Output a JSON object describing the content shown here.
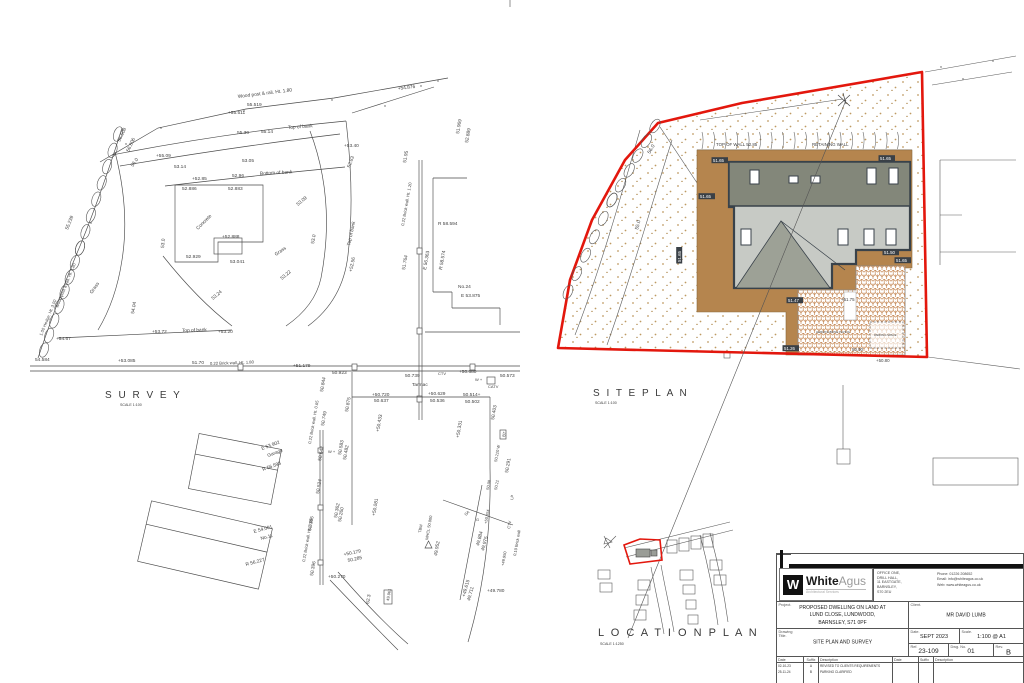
{
  "survey": {
    "title": "S U R V E Y",
    "scale_note": "SCALE 1:100",
    "labels": [
      {
        "t": "Wood post & rail. Ht. 1.80",
        "x": 238,
        "y": 98,
        "r": -7
      },
      {
        "t": "+55.511",
        "x": 228,
        "y": 114
      },
      {
        "t": "55.519",
        "x": 247,
        "y": 106
      },
      {
        "t": "+54.876",
        "x": 398,
        "y": 90,
        "r": -7
      },
      {
        "t": "55.30",
        "x": 237,
        "y": 134
      },
      {
        "t": "55.14",
        "x": 261,
        "y": 133
      },
      {
        "t": "Top of bank",
        "x": 288,
        "y": 129,
        "r": -4
      },
      {
        "t": "+53.40",
        "x": 344,
        "y": 147
      },
      {
        "t": "52.83",
        "x": 350,
        "y": 168,
        "r": -70
      },
      {
        "t": "+55.09",
        "x": 156,
        "y": 157
      },
      {
        "t": "53.14",
        "x": 174,
        "y": 168
      },
      {
        "t": "53.05",
        "x": 242,
        "y": 162
      },
      {
        "t": "52.96",
        "x": 232,
        "y": 177
      },
      {
        "t": "Bottom of bank",
        "x": 260,
        "y": 175,
        "r": -3
      },
      {
        "t": "+52.85",
        "x": 192,
        "y": 180
      },
      {
        "t": "52.886",
        "x": 182,
        "y": 190
      },
      {
        "t": "52.883",
        "x": 228,
        "y": 190
      },
      {
        "t": "Concrete",
        "x": 198,
        "y": 230,
        "r": -45
      },
      {
        "t": "+52.888",
        "x": 222,
        "y": 238
      },
      {
        "t": "52.929",
        "x": 186,
        "y": 258
      },
      {
        "t": "53.041",
        "x": 230,
        "y": 263
      },
      {
        "t": "Grass",
        "x": 276,
        "y": 256,
        "r": -35
      },
      {
        "t": "53.09",
        "x": 298,
        "y": 206,
        "r": -40
      },
      {
        "t": "53.0",
        "x": 314,
        "y": 244,
        "r": -80
      },
      {
        "t": "53.0",
        "x": 164,
        "y": 248,
        "r": -85
      },
      {
        "t": "Top of bank",
        "x": 350,
        "y": 246,
        "r": -78
      },
      {
        "t": "+52.56",
        "x": 352,
        "y": 272,
        "r": -78
      },
      {
        "t": "53.22",
        "x": 282,
        "y": 280,
        "r": -40
      },
      {
        "t": "53.24",
        "x": 213,
        "y": 300,
        "r": -40
      },
      {
        "t": "Grass",
        "x": 92,
        "y": 294,
        "r": -55
      },
      {
        "t": "56.608",
        "x": 120,
        "y": 142,
        "r": -65
      },
      {
        "t": "56.806",
        "x": 129,
        "y": 152,
        "r": -65
      },
      {
        "t": "56.0",
        "x": 133,
        "y": 167,
        "r": -55
      },
      {
        "t": "55.239",
        "x": 68,
        "y": 230,
        "r": -68
      },
      {
        "t": "Wood post & rail. Ht. 1.80",
        "x": 58,
        "y": 308,
        "r": -68,
        "s": 4.2
      },
      {
        "t": "1.00 Hedge. Ht. 3.00",
        "x": 42,
        "y": 336,
        "r": -68,
        "s": 4.2
      },
      {
        "t": "+54.67",
        "x": 56,
        "y": 340
      },
      {
        "t": "54.04",
        "x": 134,
        "y": 314,
        "r": -80
      },
      {
        "t": "+53.72",
        "x": 152,
        "y": 333
      },
      {
        "t": "Top of bank",
        "x": 182,
        "y": 332,
        "r": -2
      },
      {
        "t": "+53.20",
        "x": 218,
        "y": 333
      },
      {
        "t": "54.584",
        "x": 35,
        "y": 361
      },
      {
        "t": "+53.085",
        "x": 118,
        "y": 362
      },
      {
        "t": "51.70",
        "x": 192,
        "y": 364
      },
      {
        "t": "0.22 Brick wall. Ht. 1.80",
        "x": 210,
        "y": 365,
        "r": -2,
        "s": 4.2
      },
      {
        "t": "+51.179",
        "x": 293,
        "y": 367
      },
      {
        "t": "50.923",
        "x": 332,
        "y": 374
      },
      {
        "t": "50.844",
        "x": 323,
        "y": 392,
        "r": -80
      },
      {
        "t": "50.739",
        "x": 405,
        "y": 377
      },
      {
        "t": "CTV",
        "x": 438,
        "y": 375,
        "s": 4
      },
      {
        "t": "+50.680",
        "x": 459,
        "y": 373
      },
      {
        "t": "W +",
        "x": 475,
        "y": 381,
        "s": 4
      },
      {
        "t": "50.573",
        "x": 500,
        "y": 377
      },
      {
        "t": "CATV",
        "x": 488,
        "y": 388,
        "s": 4
      },
      {
        "t": "Tarmac",
        "x": 412,
        "y": 386
      },
      {
        "t": "+50.720",
        "x": 372,
        "y": 396
      },
      {
        "t": "50.637",
        "x": 374,
        "y": 402
      },
      {
        "t": "+50.629",
        "x": 428,
        "y": 395
      },
      {
        "t": "50.536",
        "x": 430,
        "y": 402
      },
      {
        "t": "50.514+",
        "x": 463,
        "y": 396
      },
      {
        "t": "50.502",
        "x": 465,
        "y": 403
      },
      {
        "t": "50.875",
        "x": 348,
        "y": 412,
        "r": -80
      },
      {
        "t": "+50.433",
        "x": 379,
        "y": 432,
        "r": -80
      },
      {
        "t": "+50.331",
        "x": 459,
        "y": 438,
        "r": -80
      },
      {
        "t": "50.403",
        "x": 494,
        "y": 420,
        "r": -80
      },
      {
        "t": "0.22 Brick wall. Ht. 0.65",
        "x": 311,
        "y": 444,
        "r": -80,
        "s": 4.2
      },
      {
        "t": "50.749",
        "x": 324,
        "y": 426,
        "r": -80
      },
      {
        "t": "W +",
        "x": 328,
        "y": 453,
        "s": 4
      },
      {
        "t": "50.583",
        "x": 341,
        "y": 455,
        "r": -80
      },
      {
        "t": "50.482",
        "x": 346,
        "y": 460,
        "r": -80
      },
      {
        "t": "50.642",
        "x": 321,
        "y": 461,
        "r": -80
      },
      {
        "t": "BT",
        "x": 505,
        "y": 437,
        "r": -80,
        "s": 4
      },
      {
        "t": "50.291",
        "x": 508,
        "y": 473,
        "r": -80
      },
      {
        "t": "50.210 W",
        "x": 497,
        "y": 462,
        "r": -80,
        "s": 4
      },
      {
        "t": "E 53.902",
        "x": 262,
        "y": 450,
        "r": -20
      },
      {
        "t": "Garage",
        "x": 268,
        "y": 457,
        "r": -20
      },
      {
        "t": "R 56.593",
        "x": 263,
        "y": 471,
        "r": -20
      },
      {
        "t": "E 54.001",
        "x": 254,
        "y": 533,
        "r": -15
      },
      {
        "t": "No.11",
        "x": 261,
        "y": 540,
        "r": -15
      },
      {
        "t": "R 56.227",
        "x": 246,
        "y": 566,
        "r": -15
      },
      {
        "t": "50.524",
        "x": 319,
        "y": 494,
        "r": -80
      },
      {
        "t": "50.395",
        "x": 311,
        "y": 531,
        "r": -80
      },
      {
        "t": "0.22 Brick wall. Ht. 0.65",
        "x": 305,
        "y": 562,
        "r": -80,
        "s": 4.2
      },
      {
        "t": "50.396",
        "x": 313,
        "y": 576,
        "r": -80
      },
      {
        "t": "50.362",
        "x": 337,
        "y": 518,
        "r": -80
      },
      {
        "t": "50.260",
        "x": 341,
        "y": 522,
        "r": -80
      },
      {
        "t": "+50.081",
        "x": 375,
        "y": 516,
        "r": -80
      },
      {
        "t": "+50.179",
        "x": 344,
        "y": 556,
        "r": -12
      },
      {
        "t": "50.285",
        "x": 348,
        "y": 562,
        "r": -12
      },
      {
        "t": "+50.270",
        "x": 328,
        "y": 578
      },
      {
        "t": "62.3",
        "x": 369,
        "y": 604,
        "r": -80
      },
      {
        "t": "49.961",
        "x": 389,
        "y": 601,
        "r": -80,
        "s": 4
      },
      {
        "t": "TBM",
        "x": 421,
        "y": 533,
        "r": -80,
        "s": 4
      },
      {
        "t": "MHCL 50.000",
        "x": 428,
        "y": 540,
        "r": -80,
        "s": 4
      },
      {
        "t": "49.952",
        "x": 437,
        "y": 556,
        "r": -80
      },
      {
        "t": "SA",
        "x": 466,
        "y": 516,
        "r": -45,
        "s": 4
      },
      {
        "t": "G",
        "x": 476,
        "y": 521,
        "s": 4
      },
      {
        "t": "+50.054",
        "x": 487,
        "y": 524,
        "r": -80,
        "s": 4
      },
      {
        "t": "50.08",
        "x": 489,
        "y": 490,
        "r": -80,
        "s": 4
      },
      {
        "t": "50.21",
        "x": 497,
        "y": 490,
        "r": -80,
        "s": 4
      },
      {
        "t": "49.884",
        "x": 479,
        "y": 546,
        "r": -75
      },
      {
        "t": "49.975",
        "x": 484,
        "y": 551,
        "r": -75
      },
      {
        "t": "+49.615",
        "x": 465,
        "y": 597,
        "r": -75
      },
      {
        "t": "49.711",
        "x": 470,
        "y": 601,
        "r": -75
      },
      {
        "t": "+49.780",
        "x": 487,
        "y": 592
      },
      {
        "t": "LP",
        "x": 513,
        "y": 500,
        "r": -80,
        "s": 4
      },
      {
        "t": "CTV",
        "x": 510,
        "y": 529,
        "r": -80,
        "s": 4
      },
      {
        "t": "+49.950",
        "x": 504,
        "y": 566,
        "r": -80,
        "s": 4
      },
      {
        "t": "0.10 Brick wall",
        "x": 516,
        "y": 556,
        "r": -80,
        "s": 4
      },
      {
        "t": "R 58.594",
        "x": 438,
        "y": 225
      },
      {
        "t": "E 56.363",
        "x": 426,
        "y": 270,
        "r": -80
      },
      {
        "t": "R 58.574",
        "x": 442,
        "y": 270,
        "r": -80
      },
      {
        "t": "No.24",
        "x": 458,
        "y": 288
      },
      {
        "t": "E 53.875",
        "x": 461,
        "y": 297
      },
      {
        "t": "51.95",
        "x": 406,
        "y": 163,
        "r": -80
      },
      {
        "t": "0.22 Brick wall. Ht. 1.20",
        "x": 404,
        "y": 226,
        "r": -80,
        "s": 4.2
      },
      {
        "t": "51.764",
        "x": 405,
        "y": 270,
        "r": -80
      },
      {
        "t": "51.969",
        "x": 459,
        "y": 134,
        "r": -80
      },
      {
        "t": "52.889",
        "x": 468,
        "y": 143,
        "r": -80
      },
      {
        "t": "x",
        "x": 125,
        "y": 145,
        "s": 4
      },
      {
        "t": "x",
        "x": 160,
        "y": 129,
        "s": 4
      },
      {
        "t": "x",
        "x": 243,
        "y": 112,
        "s": 4
      },
      {
        "t": "x",
        "x": 331,
        "y": 101,
        "s": 4
      },
      {
        "t": "x",
        "x": 420,
        "y": 87,
        "s": 4
      },
      {
        "t": "x",
        "x": 384,
        "y": 107,
        "s": 4
      },
      {
        "t": "x",
        "x": 437,
        "y": 82,
        "s": 4
      },
      {
        "t": "x",
        "x": 90,
        "y": 224,
        "s": 4
      },
      {
        "t": "x",
        "x": 60,
        "y": 298,
        "s": 4
      }
    ]
  },
  "site_plan": {
    "title": "S I T E  P L A N",
    "scale_note": "SCALE 1:100",
    "labels": [
      {
        "t": "TOP OF WALL 52.85",
        "x": 716,
        "y": 146,
        "s": 4.4
      },
      {
        "t": "RETAINING WALL",
        "x": 812,
        "y": 146,
        "s": 4.4
      },
      {
        "t": "56.0",
        "x": 650,
        "y": 154,
        "r": -60,
        "s": 5
      },
      {
        "t": "55.0",
        "x": 638,
        "y": 230,
        "r": -75,
        "s": 5
      },
      {
        "t": "51.65",
        "x": 713,
        "y": 162,
        "chip": true
      },
      {
        "t": "51.65",
        "x": 700,
        "y": 198,
        "chip": true
      },
      {
        "t": "51.65",
        "x": 681,
        "y": 262,
        "r": -90,
        "chip": true
      },
      {
        "t": "51.65",
        "x": 880,
        "y": 160,
        "chip": true
      },
      {
        "t": "51.50",
        "x": 884,
        "y": 254,
        "chip": true
      },
      {
        "t": "51.65",
        "x": 896,
        "y": 262,
        "chip": true
      },
      {
        "t": "51.47",
        "x": 788,
        "y": 302,
        "chip": true
      },
      {
        "t": "51.26",
        "x": 784,
        "y": 350,
        "chip": true
      },
      {
        "t": "+51.75",
        "x": 841,
        "y": 301
      },
      {
        "t": "50.90",
        "x": 852,
        "y": 351
      },
      {
        "t": "+50.80",
        "x": 876,
        "y": 362
      },
      {
        "t": "HERRINGBONE PAVING",
        "x": 816,
        "y": 333,
        "s": 3
      },
      {
        "t": "PARKING SPACE",
        "x": 874,
        "y": 336,
        "s": 2.8
      },
      {
        "t": "x",
        "x": 940,
        "y": 68,
        "s": 4
      },
      {
        "t": "x",
        "x": 962,
        "y": 80,
        "s": 4
      },
      {
        "t": "x",
        "x": 992,
        "y": 62,
        "s": 4
      }
    ]
  },
  "location_plan": {
    "title": "L O C A T I O N  P L A N",
    "scale_note": "SCALE 1:1250"
  },
  "title_block": {
    "logo": {
      "glyph": "W",
      "bold": "White",
      "light": "Agus",
      "tagline": "Architectural Services"
    },
    "office": "OFFICE ONE,\nDRILL HALL,\n11 EASTGATE,\nBARNSLEY,\nS70 2EU",
    "contact": "Phone: 01226 208652\nEmail: info@whiteagus.co.uk\nWeb: www.whiteagus.co.uk",
    "project_label": "Project.",
    "project": "PROPOSED DWELLING ON LAND AT\nLUND CLOSE, LUNDWOOD,\nBARNSLEY, S71 0PF",
    "client_label": "Client.",
    "client": "MR DAVID LUMB",
    "drawing_title_label": "Drawing\nTitle.",
    "drawing_title": "SITE PLAN AND SURVEY",
    "date_label": "Date.",
    "date": "SEPT 2023",
    "scale_label": "Scale.",
    "scale": "1:100 @ A1",
    "ref_label": "Ref.",
    "ref": "23-109",
    "dwg_label": "Dwg. No.",
    "dwg": "01",
    "rev_label": "Rev.",
    "rev": "B",
    "rev_table": {
      "headers": [
        "Date",
        "Suffix",
        "Description",
        "Date",
        "Suffix",
        "Description"
      ],
      "rows": [
        {
          "date": "02-10-23",
          "suffix": "A",
          "description": "REVISED TO CLIENTS REQUIREMENTS"
        },
        {
          "date": "25-11-24",
          "suffix": "B",
          "description": "PARKING CLARIFIED"
        }
      ]
    }
  }
}
